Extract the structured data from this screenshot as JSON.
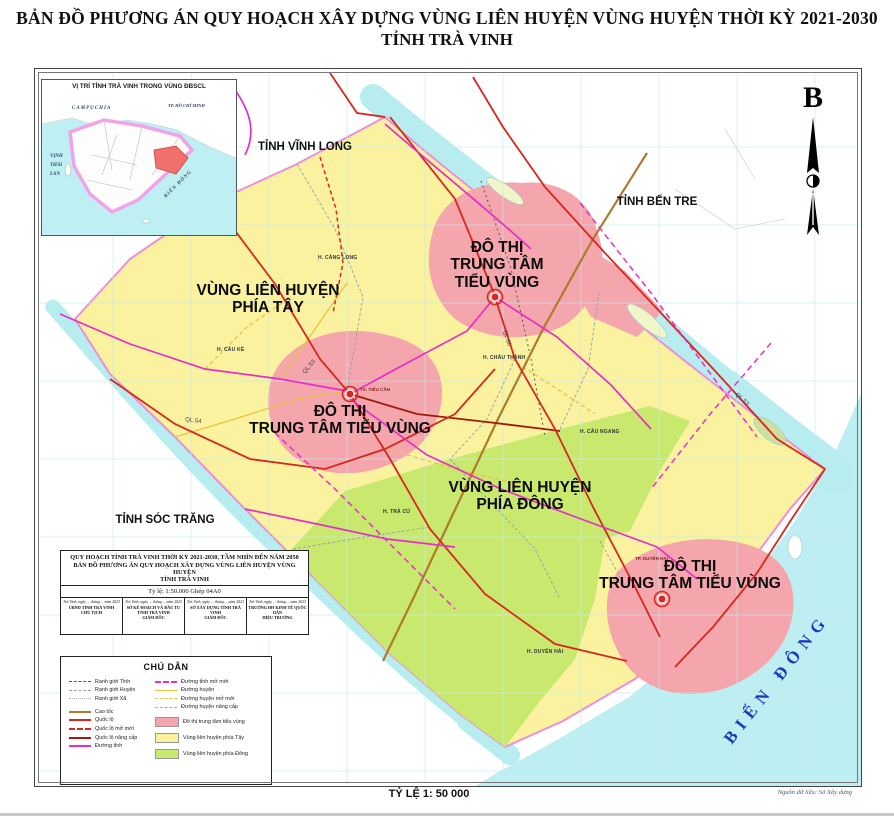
{
  "page": {
    "title_line1": "BẢN ĐỒ PHƯƠNG ÁN QUY HOẠCH XÂY DỰNG VÙNG LIÊN HUYỆN VÙNG HUYỆN THỜI KỲ 2021-2030",
    "title_line2": "TỈNH TRÀ VINH",
    "scale_label": "TỶ LỆ 1: 50 000",
    "source_label": "Nguồn dữ liệu: Sở Xây dựng"
  },
  "north_arrow": {
    "label": "B"
  },
  "inset": {
    "title": "VỊ TRÍ TỈNH TRÀ VINH TRONG VÙNG ĐBSCL",
    "label_campuchia": "CAMPUCHIA",
    "label_hcm": "TP. HỒ CHÍ MINH",
    "label_vinh_thai_lan": "VỊNH\nTHÁI\nLAN",
    "label_bien_dong": "BIỂN ĐÔNG"
  },
  "map": {
    "neighbors": {
      "vinh_long": "TỈNH VĨNH LONG",
      "ben_tre": "TỈNH BẾN TRE",
      "soc_trang": "TỈNH SÓC TRĂNG"
    },
    "sea": "BIỂN ĐÔNG",
    "regions": {
      "west": "VÙNG LIÊN HUYỆN\nPHÍA TÂY",
      "east": "VÙNG LIÊN HUYỆN\nPHÍA ĐÔNG",
      "urban_top": "ĐÔ THỊ\nTRUNG TÂM\nTIỂU VÙNG",
      "urban_mid": "ĐÔ THỊ\nTRUNG TÂM TIỂU VÙNG",
      "urban_se": "ĐÔ THỊ\nTRUNG TÂM TIỂU VÙNG"
    },
    "districts": [
      "H. CÀNG LONG",
      "H. CẦU KÈ",
      "H. CHÂU THÀNH",
      "H. CẦU NGANG",
      "H. TRÀ CÚ",
      "H. DUYÊN HẢI"
    ],
    "towns": [
      "TX. TIỂU CẦN",
      "TP. DUYÊN HẢI"
    ],
    "road_labels": [
      "QL.53",
      "QL.54",
      "QL.60",
      "QL.53"
    ]
  },
  "title_block": {
    "line1": "QUY HOẠCH TỈNH TRÀ VINH THỜI KỲ 2021-2030, TẦM NHÌN ĐẾN NĂM 2050",
    "line2": "BẢN ĐỒ PHƯƠNG ÁN QUY HOẠCH XÂY DỰNG VÙNG LIÊN HUYỆN VÙNG HUYỆN",
    "line3": "TỈNH TRÀ VINH",
    "scale_line": "Tỷ lệ:  1:50.000  Ghép 04A0",
    "signatures": [
      {
        "date": "Trà Vinh, ngày ... tháng ... năm 2023",
        "org": "UBND TỈNH TRÀ VINH",
        "role": "CHỦ TỊCH"
      },
      {
        "date": "Trà Vinh, ngày ... tháng ... năm 2023",
        "org": "SỞ KẾ HOẠCH VÀ ĐẦU TƯ TỈNH TRÀ VINH",
        "role": "GIÁM ĐỐC"
      },
      {
        "date": "Trà Vinh, ngày ... tháng ... năm 2023",
        "org": "SỞ XÂY DỰNG TỈNH TRÀ VINH",
        "role": "GIÁM ĐỐC"
      },
      {
        "date": "Trà Vinh, ngày ... tháng ... năm 2023",
        "org": "TRƯỜNG ĐH KINH TẾ QUỐC DÂN",
        "role": "HIỆU TRƯỞNG"
      }
    ]
  },
  "legend": {
    "title": "CHÚ DẪN",
    "left": [
      "Ranh giới Tỉnh",
      "Ranh giới Huyện",
      "Ranh giới Xã",
      "Cao tốc",
      "Quốc lộ",
      "Quốc lộ mở mới",
      "Quốc lộ nâng cấp",
      "Đường tỉnh"
    ],
    "right": [
      "Đường tỉnh mở mới",
      "Đường huyện",
      "Đường huyện mở mới",
      "Đường huyện nâng cấp",
      "Đô thị trung tâm tiểu vùng",
      "Vùng liên huyện phía Tây",
      "Vùng liên huyện phía Đông"
    ]
  },
  "colors": {
    "urban_fill": "#F4A6AC",
    "west_fill": "#FBF2A0",
    "east_fill": "#C9E96E",
    "sea_fill": "#BDEFF2",
    "national_road": "#D6281E",
    "province_road": "#E62EC8",
    "expressway": "#AD7A2E",
    "district_road": "#E9C243",
    "sea_label_color": "#1C39BB"
  }
}
